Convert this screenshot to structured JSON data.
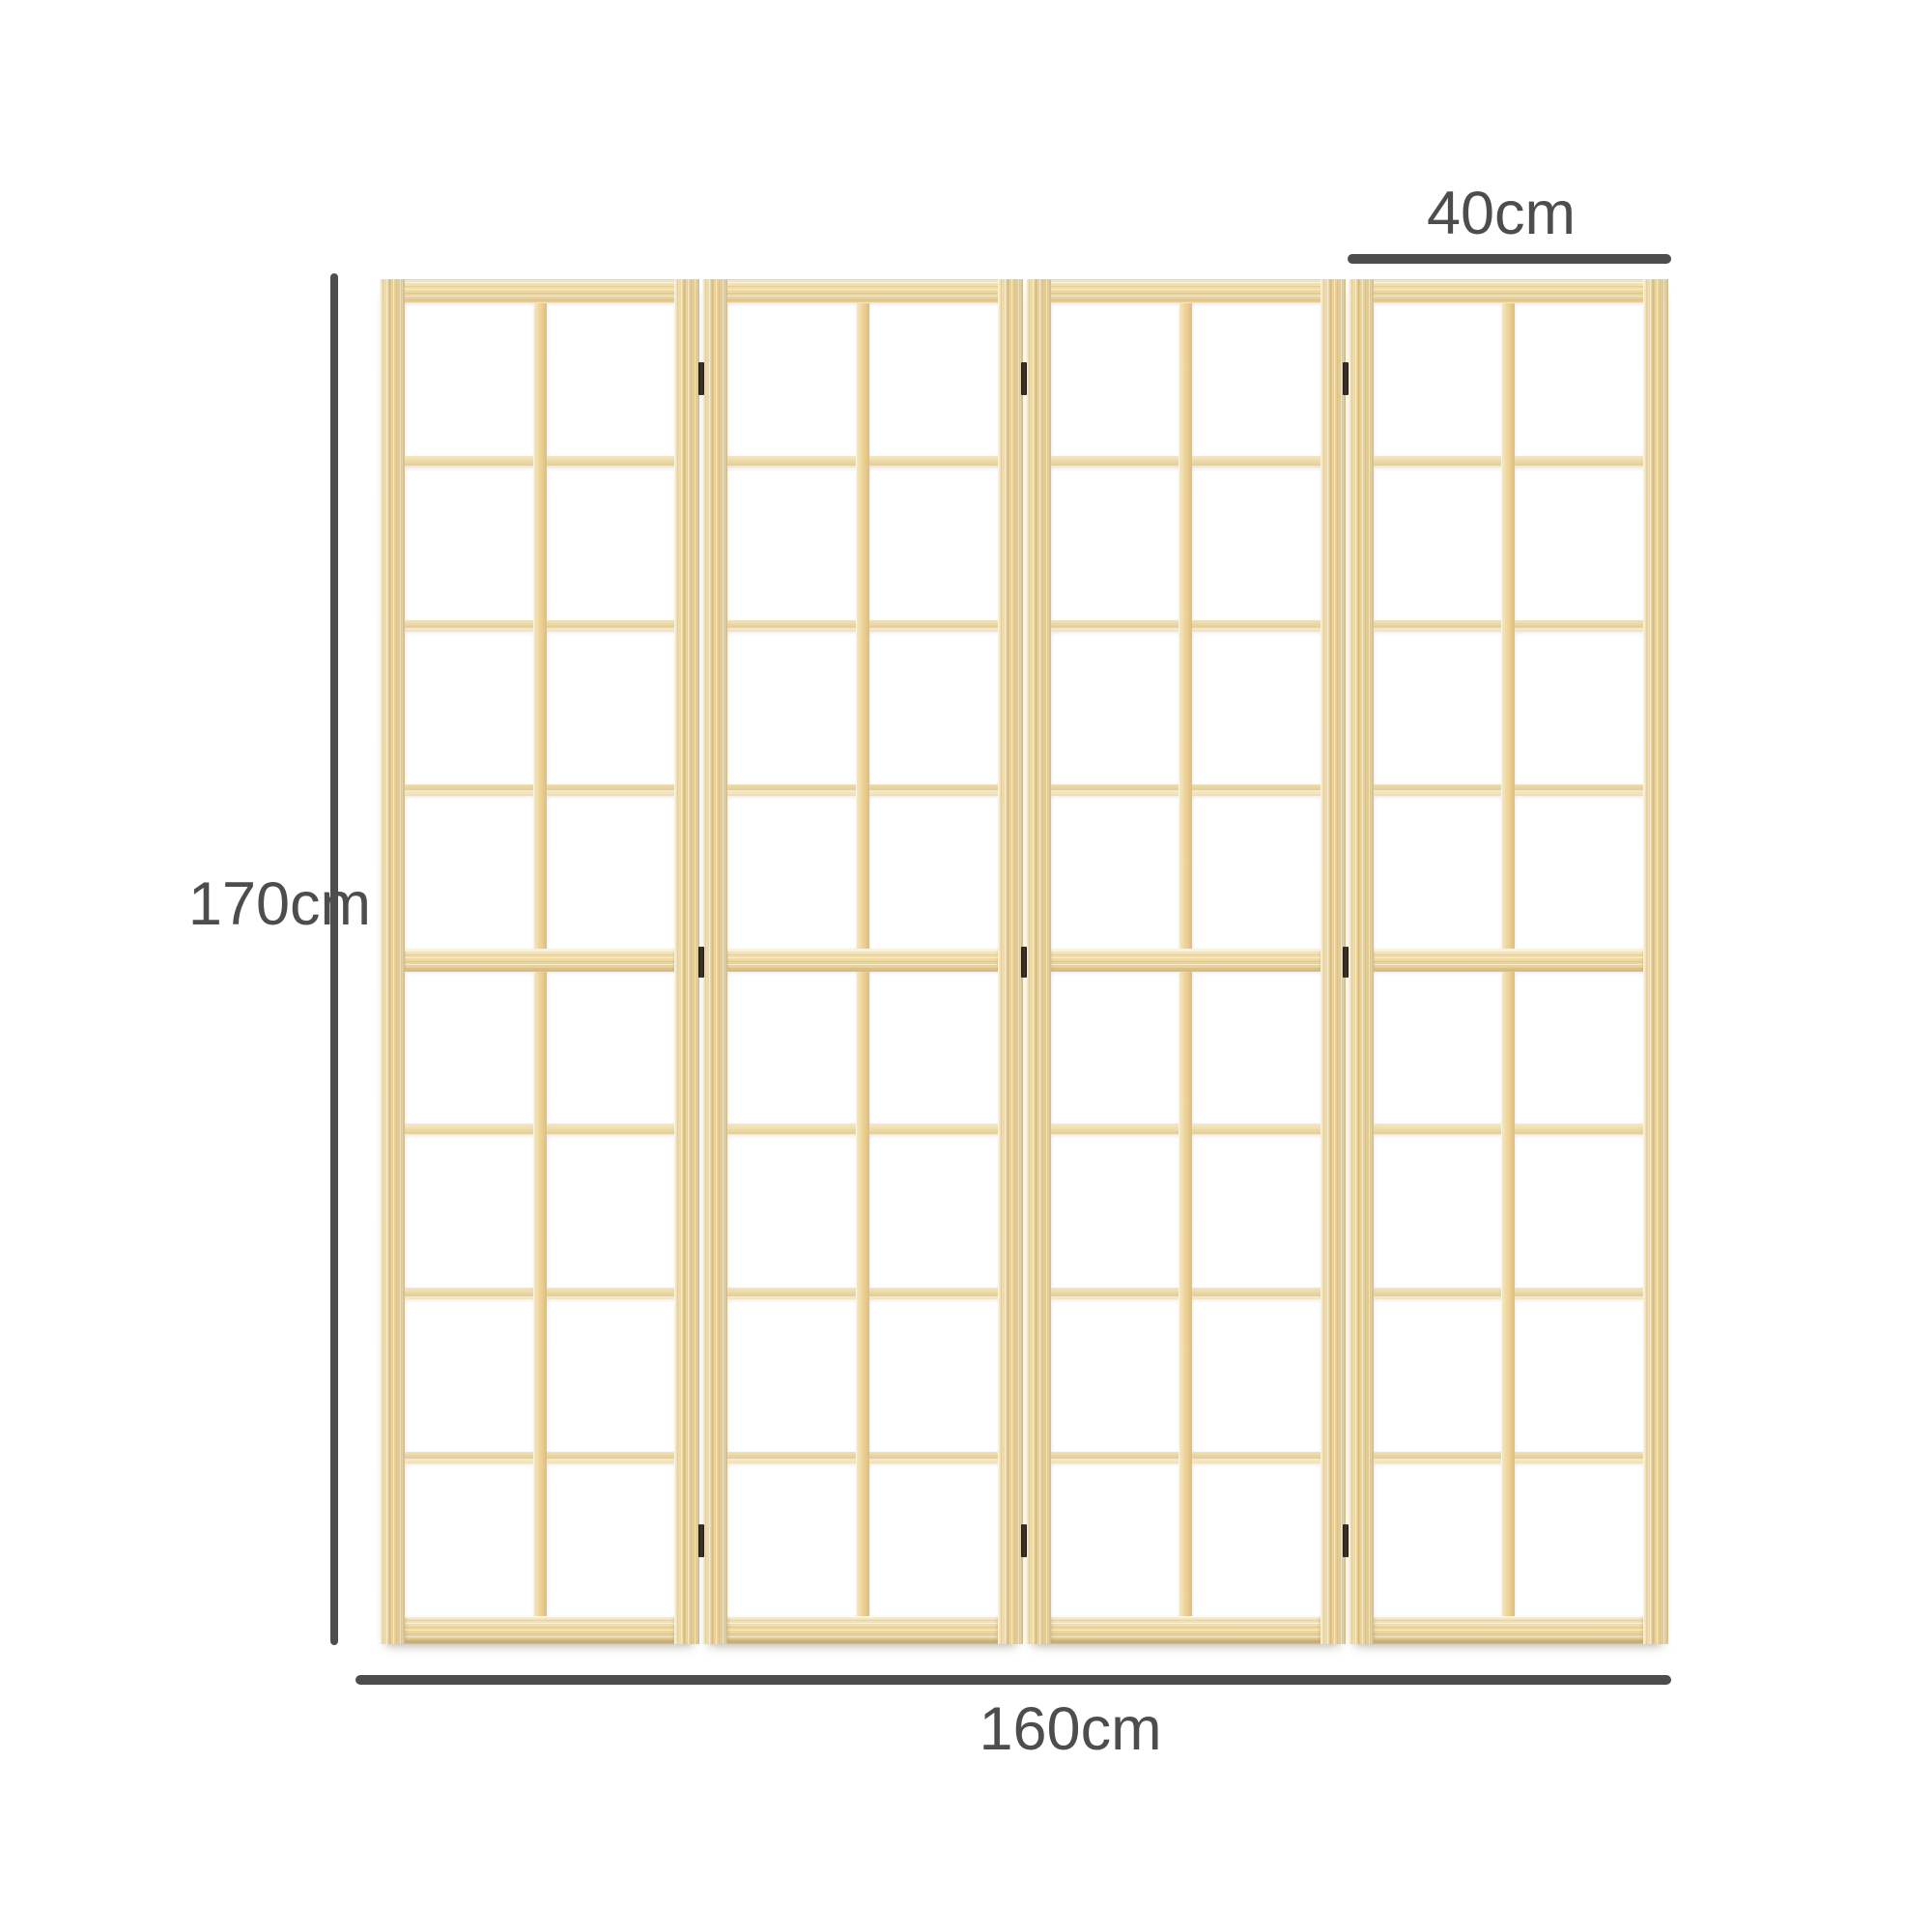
{
  "product": {
    "name": "four-panel-folding-room-divider",
    "panel_count": 4,
    "cells_per_panel": {
      "columns": 2,
      "rows_top_half": 4,
      "rows_bottom_half": 4
    },
    "hinge_columns": 3,
    "hinges_per_column": 3
  },
  "dimensions": {
    "height_label": "170cm",
    "width_label": "160cm",
    "panel_width_label": "40cm"
  },
  "colors": {
    "background": "#ffffff",
    "annotation": "#4d4d4d",
    "wood_base": "#ecd59c",
    "wood_light": "#f7eabf",
    "wood_dark": "#dcbf7e",
    "paper": "#ffffff",
    "hinge": "#352d22"
  }
}
